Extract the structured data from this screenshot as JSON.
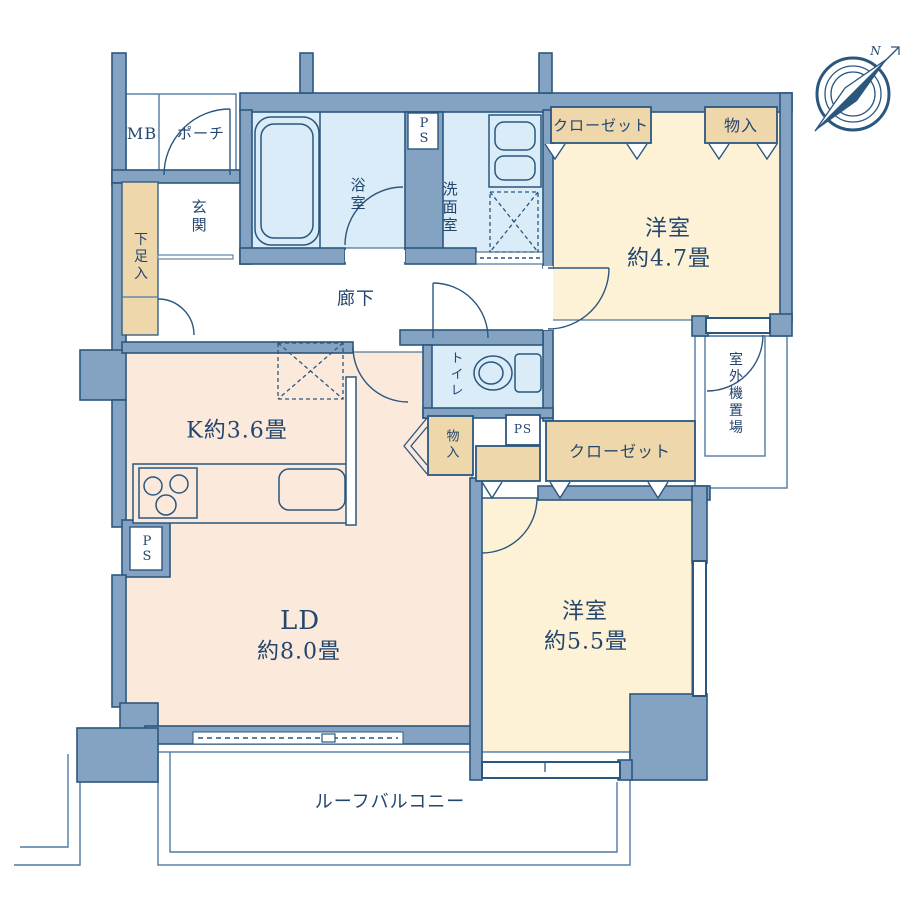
{
  "floorplan": {
    "labels": {
      "mb": "MB",
      "porch": "ポーチ",
      "genkan": "玄関",
      "shoe_box": "下足入",
      "bath": "浴室",
      "washroom": "洗面室",
      "ps_top": "PS",
      "ps_left": "PS",
      "ps_mid": "PS",
      "closet_top": "クローゼット",
      "storage_top": "物入",
      "western47_line1": "洋室",
      "western47_line2": "約4.7畳",
      "corridor": "廊下",
      "toilet": "トイレ",
      "storage_side": "物入",
      "storage_mid": "物入",
      "closet_mid": "クローゼット",
      "outdoor_unit": "室外機置場",
      "kitchen": "K約3.6畳",
      "ld_line1": "LD",
      "ld_line2": "約8.0畳",
      "western55_line1": "洋室",
      "western55_line2": "約5.5畳",
      "roof_balcony": "ルーフバルコニー",
      "compass_north": "N"
    },
    "colors": {
      "wall": "#84a3c2",
      "line": "#2b577f",
      "thin": "#4f7aa3",
      "water": "#d9ecf7",
      "ldk": "#fbe9dc",
      "room": "#fdf2d6",
      "closet": "#eed7ab",
      "text": "#24466e",
      "white": "#ffffff"
    }
  }
}
